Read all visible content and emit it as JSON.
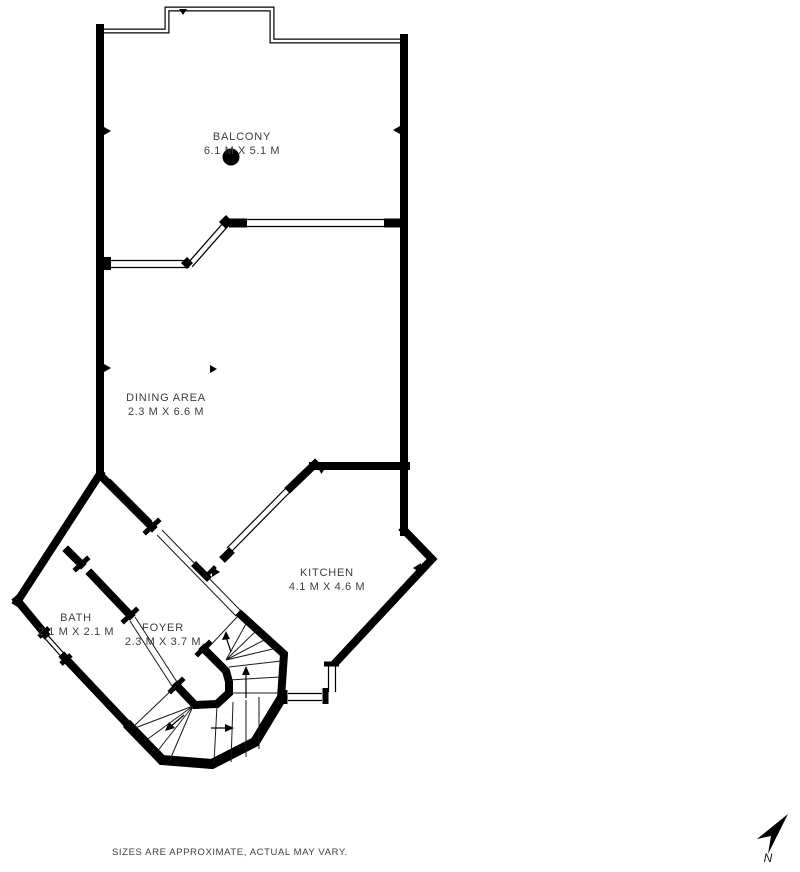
{
  "plan": {
    "title": "floor plan",
    "background_color": "#ffffff",
    "wall_color": "#000000",
    "text_color": "#3d3d3d",
    "rooms": [
      {
        "name": "BALCONY",
        "dimensions": "6.1 M X 5.1 M"
      },
      {
        "name": "DINING AREA",
        "dimensions": "2.3 M X 6.6 M"
      },
      {
        "name": "KITCHEN",
        "dimensions": "4.1 M X 4.6 M"
      },
      {
        "name": "BATH",
        "dimensions": "2.1 M X 2.1 M"
      },
      {
        "name": "FOYER",
        "dimensions": "2.3 M X 3.7 M"
      }
    ],
    "footer": {
      "disclaimer": "SIZES ARE APPROXIMATE, ACTUAL MAY VARY."
    },
    "compass": {
      "label": "N"
    }
  }
}
